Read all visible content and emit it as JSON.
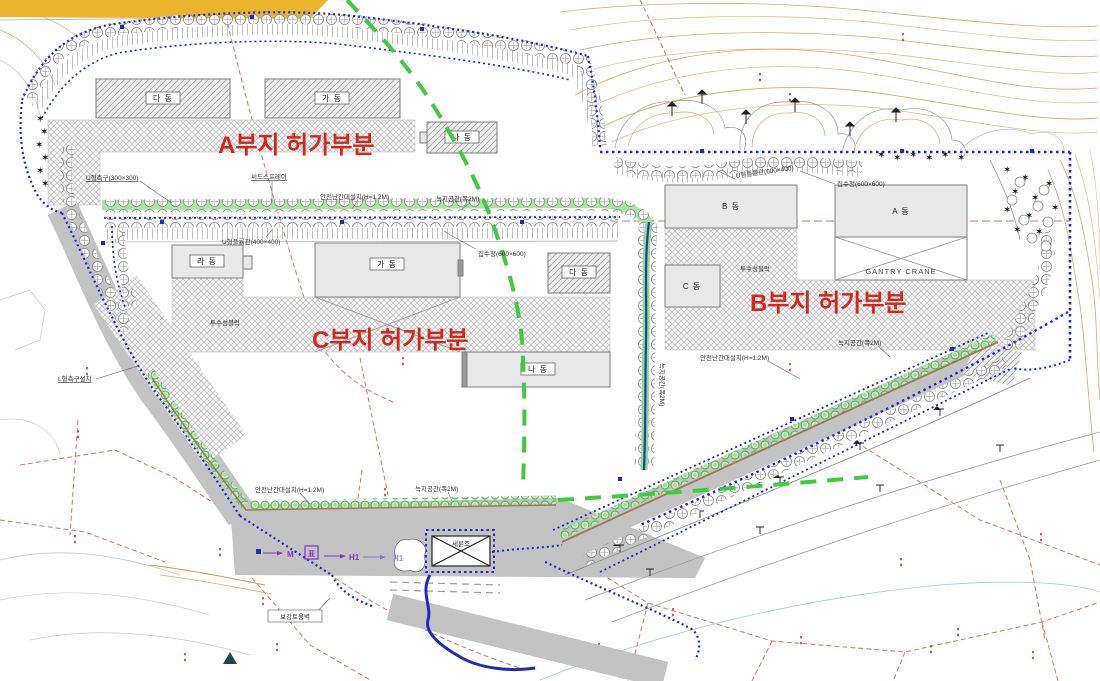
{
  "areas": {
    "a": "A부지 허가부분",
    "b": "B부지 허가부분",
    "c": "C부지 허가부분"
  },
  "buildings": {
    "a_da": "다 동",
    "a_ga": "가 동",
    "a_na": "나 동",
    "c_ra": "라 동",
    "c_ga": "가 동",
    "c_da": "다 동",
    "c_na": "나 동",
    "b_b": "B 동",
    "b_a": "A 동",
    "b_c": "C 동",
    "gantry": "GANTRY CRANE"
  },
  "annotations": {
    "u_gutter300": "U형측구(300×300)",
    "seed_spray": "씨드스프레이",
    "railing": "안전난간대설치(H=1.2M)",
    "green2m": "녹지공간(폭2M)",
    "flume400": "U형플륨관(400×400)",
    "flume600": "U형플륨관(600×400)",
    "catch600": "집수정(600×600)",
    "l_gutter": "L형측구설치",
    "retaining_wall": "보강토옹벽",
    "wheel_wash": "세륜조",
    "permeable": "투수성블럭"
  },
  "markers": {
    "m": "M",
    "pyo": "표",
    "h1": "H1"
  },
  "colors": {
    "boundary_blue": "#1f2bbf",
    "green_line": "#3fca3f",
    "yellow_zone": "#eab42c",
    "road_gray": "#c3c3c3",
    "red_label": "#d3271c",
    "parcel_red": "#cf7a6a",
    "contour_tan": "#d8a868",
    "marker_purple": "#8833cc"
  }
}
